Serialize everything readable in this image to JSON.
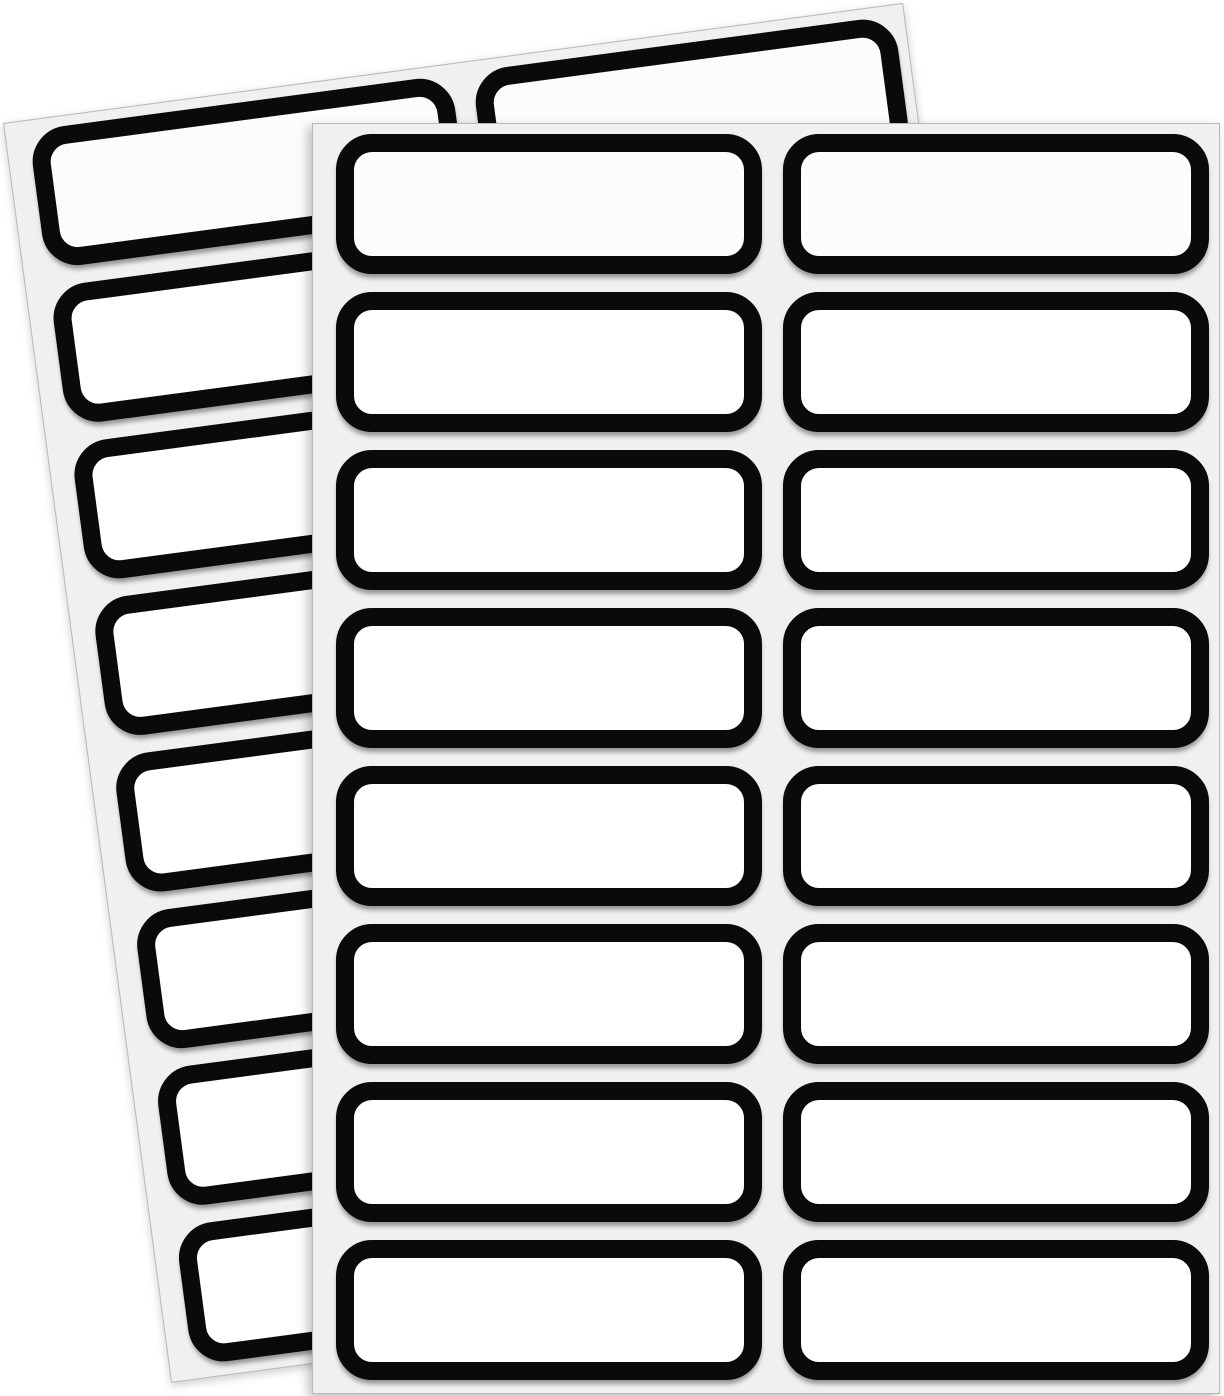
{
  "canvas": {
    "width": 1224,
    "height": 1396,
    "background_color": "#ffffff"
  },
  "sheets": [
    {
      "name": "label-sheet-back",
      "left": 3,
      "top": 123,
      "width": 908,
      "height": 1271,
      "rotation_deg": -7.6,
      "background_color": "#f0f0f1",
      "edge_color": "#b8b8b8",
      "z_index": 1
    },
    {
      "name": "label-sheet-front",
      "left": 312,
      "top": 123,
      "width": 908,
      "height": 1271,
      "rotation_deg": 0,
      "background_color": "#f0f0f1",
      "edge_color": "#b8b8b8",
      "z_index": 2
    }
  ],
  "label_grid": {
    "columns": 2,
    "rows": 8,
    "column_lefts": [
      23,
      470
    ],
    "first_row_top": 10,
    "row_pitch": 158,
    "label_width": 426,
    "label_height": 140
  },
  "label_style": {
    "border_color": "#0a0a0a",
    "border_thickness": 18,
    "corner_radius": 36,
    "fill_color": "#ffffff",
    "fill_color_first_row": "#fbfdfc",
    "text": ""
  },
  "counts": {
    "labels_per_sheet": 16,
    "total_labels": 32
  }
}
